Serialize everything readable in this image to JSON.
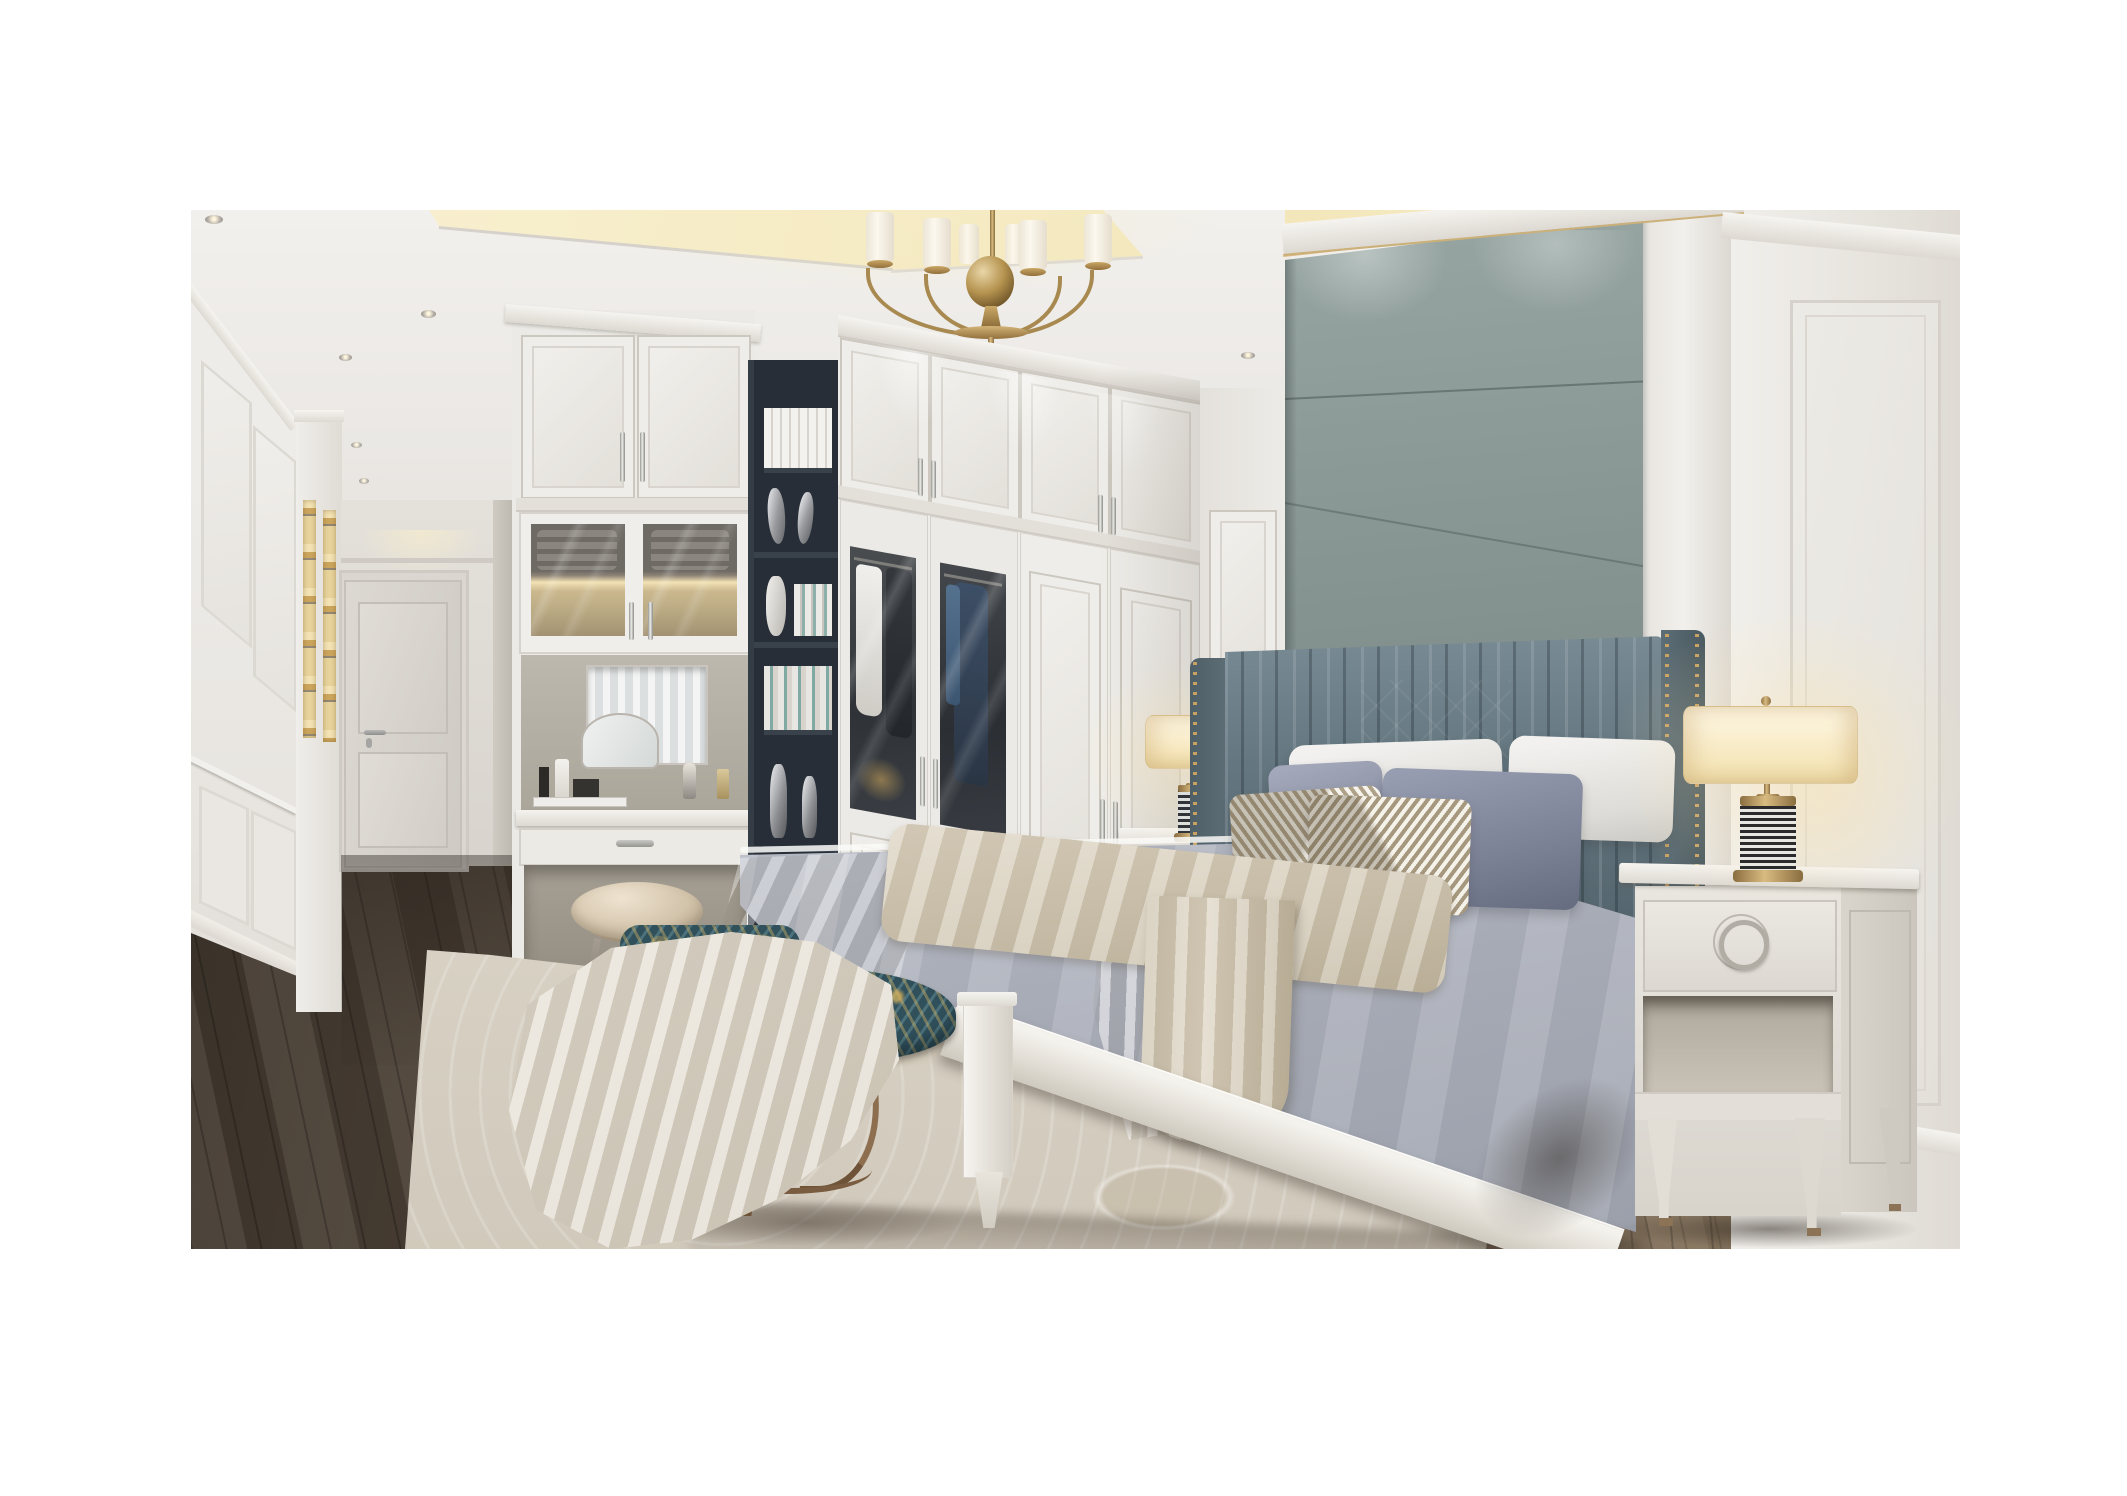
{
  "meta": {
    "domain": "Natural-Image",
    "description": "Photorealistic 3D interior render of a classic light-luxury bedroom: white built-in wardrobes and vanity, gray-green upholstered accent wall with gold trim, channel-tufted headboard, layered gray bedding, brass chandelier and striped-base table lamps, peacock-pattern bench, cream area rug on dark hardwood floor",
    "canvas_width": 2127,
    "canvas_height": 1496
  },
  "photo": {
    "left": 191,
    "top": 210,
    "width": 1769,
    "height": 1039
  },
  "palette": {
    "paper": "#ffffff",
    "ceiling": "#efedea",
    "cove": "#f6ecc6",
    "wall": "#eceae6",
    "wall-shade": "#dedad4",
    "accent": "#8a9896",
    "accent-dark": "#707d7b",
    "headboard": "#64767f",
    "gold": "#c2a066",
    "brass": "#b08c4f",
    "shelf-dark": "#272e37",
    "duvet": "#c3c7cf",
    "sheet": "#f0efec",
    "throw": "#d6cdba",
    "rug": "#ded7ca",
    "floor-dark": "#51463b",
    "floor-light": "#8b795f",
    "bench-teal": "#30505c",
    "bench-gold": "#c9a24b",
    "bronze": "#85674a",
    "stool-leather": "#d8cbb6"
  },
  "objects": [
    {
      "id": 0,
      "label": "Tray ceiling with warm cove lighting"
    },
    {
      "id": 1,
      "label": "Recessed ceiling downlight"
    },
    {
      "id": 2,
      "label": "Brass chandelier with cylindrical shades"
    },
    {
      "id": 3,
      "label": "White paneled side wall"
    },
    {
      "id": 4,
      "label": "Lit display niches"
    },
    {
      "id": 5,
      "label": "Hallway"
    },
    {
      "id": 6,
      "label": "Paneled interior door"
    },
    {
      "id": 7,
      "label": "Built-in vanity cabinet with lit glass hutch"
    },
    {
      "id": 8,
      "label": "Vanity mirror with cosmetics"
    },
    {
      "id": 9,
      "label": "Vanity dressing stool"
    },
    {
      "id": 10,
      "label": "Dark open bookshelf column with books and silver vases"
    },
    {
      "id": 11,
      "label": "White built-in wardrobe with glass garment doors"
    },
    {
      "id": 12,
      "label": "Gray-green upholstered accent wall with gold trim"
    },
    {
      "id": 13,
      "label": "Channel-tufted headboard with nailhead trim"
    },
    {
      "id": 14,
      "label": "Bed with gray duvet and white sheets"
    },
    {
      "id": 15,
      "label": "Layered bed pillows"
    },
    {
      "id": 16,
      "label": "Beige throw blanket across bed"
    },
    {
      "id": 17,
      "label": "Foot-of-bed bench with peacock patterned cushion"
    },
    {
      "id": 18,
      "label": "Cream throw draped over bench"
    },
    {
      "id": 19,
      "label": "Left nightstand"
    },
    {
      "id": 20,
      "label": "Right nightstand with ring-pull drawer"
    },
    {
      "id": 21,
      "label": "Table lamp with striped ceramic base (left)"
    },
    {
      "id": 22,
      "label": "Table lamp with striped ceramic base (right)"
    },
    {
      "id": 23,
      "label": "Cream patterned area rug"
    },
    {
      "id": 24,
      "label": "Dark hardwood plank floor"
    },
    {
      "id": 25,
      "label": "White paneled right wall"
    }
  ]
}
